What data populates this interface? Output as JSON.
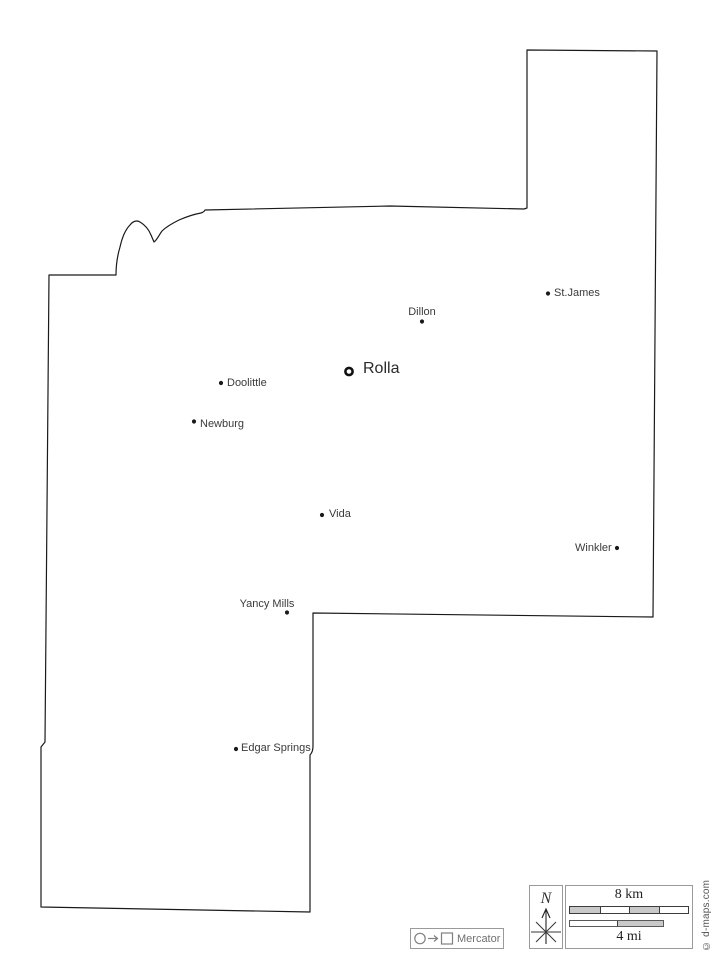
{
  "map": {
    "cities": [
      {
        "name": "Rolla",
        "type": "county-seat"
      },
      {
        "name": "Dillon",
        "type": "town"
      },
      {
        "name": "St.James",
        "type": "town"
      },
      {
        "name": "Doolittle",
        "type": "town"
      },
      {
        "name": "Newburg",
        "type": "town"
      },
      {
        "name": "Vida",
        "type": "town"
      },
      {
        "name": "Winkler",
        "type": "town"
      },
      {
        "name": "Yancy Mills",
        "type": "town"
      },
      {
        "name": "Edgar Springs",
        "type": "town"
      }
    ]
  },
  "legend": {
    "north_label": "N",
    "scale_km_label": "8 km",
    "scale_mi_label": "4 mi",
    "projection_label": "Mercator"
  },
  "credit_text": "© d-maps.com",
  "colors": {
    "boundary": "#1a1a1a",
    "city_dot": "#1a1a1a",
    "label_text": "#3a3a3a",
    "legend_border": "#9a9a9a",
    "legend_gray": "#808080",
    "scale_fill": "#c9c9c9"
  }
}
